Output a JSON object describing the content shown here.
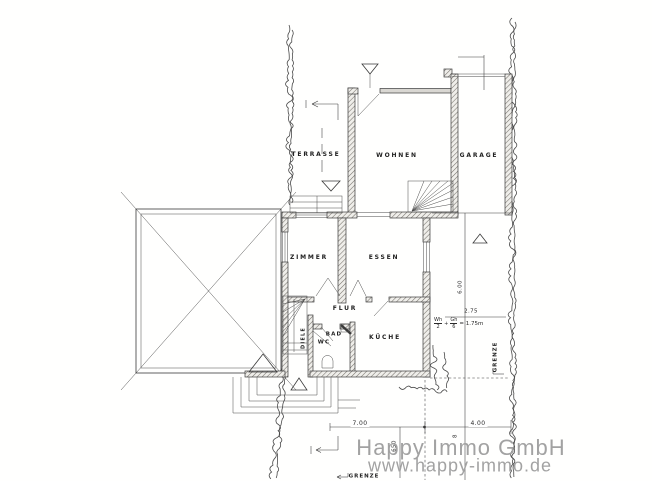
{
  "plan": {
    "rooms": {
      "terrasse": "TERRASSE",
      "wohnen": "WOHNEN",
      "garage": "GARAGE",
      "zimmer": "ZIMMER",
      "essen": "ESSEN",
      "flur": "FLUR",
      "bad": "BAD",
      "wc": "WC",
      "kueche": "KÜCHE",
      "diele": "DIELE"
    },
    "annotations": {
      "dim_700": "7.00",
      "dim_400": "4.00",
      "dim_650": "650",
      "dim_8": "8",
      "dim_600": "6.00",
      "dim_275": "2.75",
      "formula": {
        "num1": "Wh",
        "den1": "2",
        "plus": "+",
        "num2": "Gh",
        "den2": "6",
        "result": "= 1.75m"
      },
      "grenze_bottom": "GRENZE",
      "grenze_right": "GRENZE"
    },
    "watermark": {
      "line1": "Happy Immo GmbH",
      "line2": "www.happy-immo.de"
    },
    "colors": {
      "ink": "#3a3a3a",
      "watermark": "#a2a2a2"
    }
  }
}
